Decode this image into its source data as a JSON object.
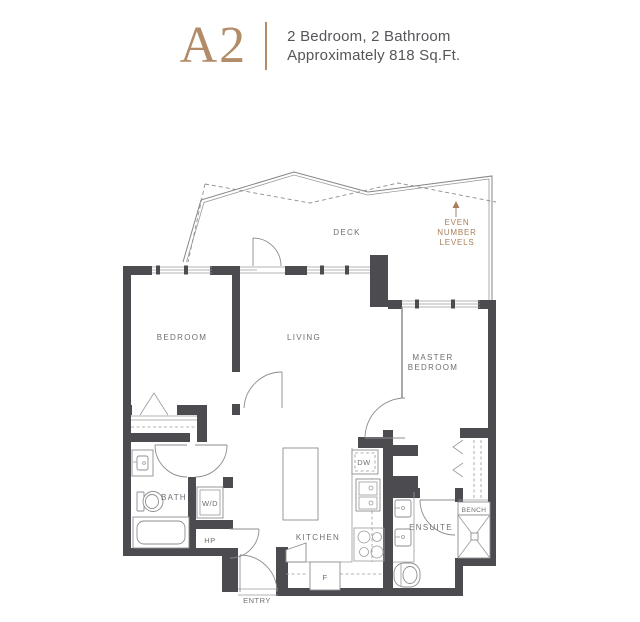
{
  "header": {
    "unit_name": "A2",
    "description_line1": "2 Bedroom, 2 Bathroom",
    "description_line2": "Approximately 818 Sq.Ft."
  },
  "floorplan": {
    "colors": {
      "accent": "#b28c68",
      "wall": "#4b4b50",
      "note": "#a87e58",
      "label": "#6f6f73",
      "text": "#55565a",
      "line": "#85858a"
    },
    "labels": {
      "deck": "DECK",
      "even_line1": "EVEN",
      "even_line2": "NUMBER",
      "even_line3": "LEVELS",
      "bedroom": "BEDROOM",
      "living": "LIVING",
      "master_line1": "MASTER",
      "master_line2": "BEDROOM",
      "bath": "BATH",
      "washer_dryer": "W/D",
      "heat_pump": "HP",
      "kitchen": "KITCHEN",
      "fridge": "F",
      "dishwasher": "DW",
      "ensuite": "ENSUITE",
      "bench": "BENCH",
      "entry": "ENTRY"
    }
  }
}
